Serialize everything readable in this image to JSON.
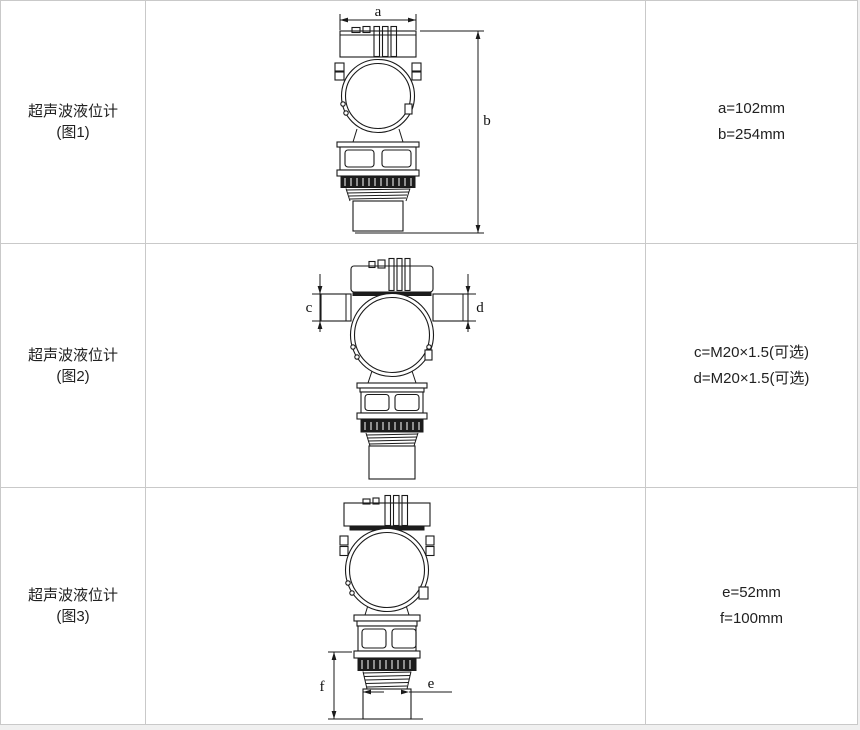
{
  "table": {
    "border_color": "#c9c9c9",
    "cell_background": "#ffffff",
    "page_background": "#f0f0f0",
    "line_color": "#1a1a1a"
  },
  "rows": [
    {
      "product": "超声波液位计",
      "figure": "(图1)",
      "specs": {
        "line1": "a=102mm",
        "line2": "b=254mm"
      },
      "dims": {
        "width_label": "a",
        "height_label": "b"
      }
    },
    {
      "product": "超声波液位计",
      "figure": "(图2)",
      "specs": {
        "line1": "c=M20×1.5(可选)",
        "line2": "d=M20×1.5(可选)"
      },
      "dims": {
        "left_entry_label": "c",
        "right_entry_label": "d"
      }
    },
    {
      "product": "超声波液位计",
      "figure": "(图3)",
      "specs": {
        "line1": "e=52mm",
        "line2": "f=100mm"
      },
      "dims": {
        "probe_diameter_label": "e",
        "probe_length_label": "f"
      }
    }
  ]
}
